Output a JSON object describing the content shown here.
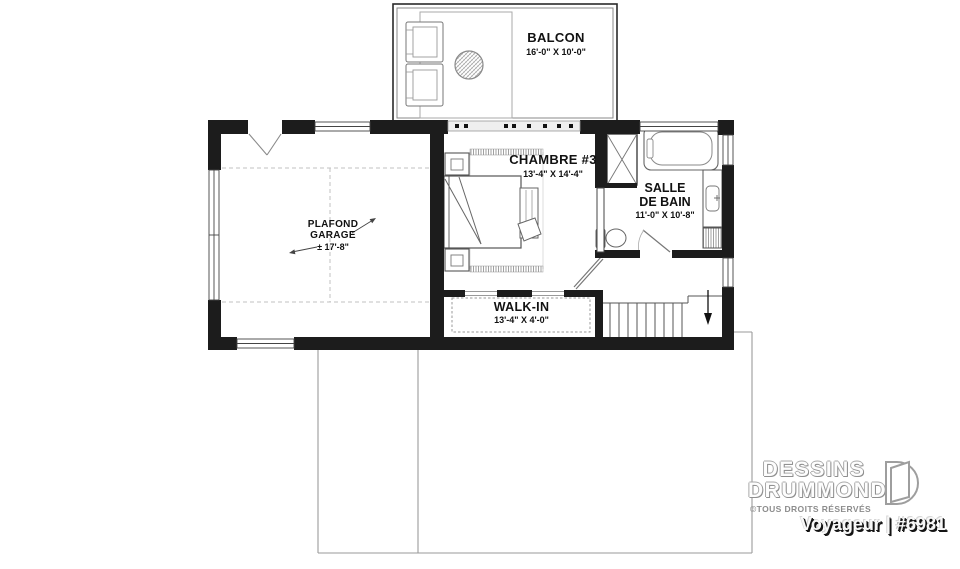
{
  "plan": {
    "rooms": {
      "balcon": {
        "name": "BALCON",
        "dims": "16'-0\" X 10'-0\""
      },
      "chambre": {
        "name": "CHAMBRE #3",
        "dims": "13'-4\" X 14'-4\""
      },
      "salle_de_bain": {
        "name_line1": "SALLE",
        "name_line2": "DE BAIN",
        "dims": "11'-0\" X 10'-8\""
      },
      "garage": {
        "name_line1": "PLAFOND",
        "name_line2": "GARAGE",
        "dims": "± 17'-8\""
      },
      "walk_in": {
        "name": "WALK-IN",
        "dims": "13'-4\" X 4'-0\""
      }
    }
  },
  "branding": {
    "company_line1": "DESSINS",
    "company_line2": "DRUMMOND",
    "rights": "©TOUS DROITS RÉSERVÉS",
    "plan_title": "Voyageur | #6981"
  }
}
